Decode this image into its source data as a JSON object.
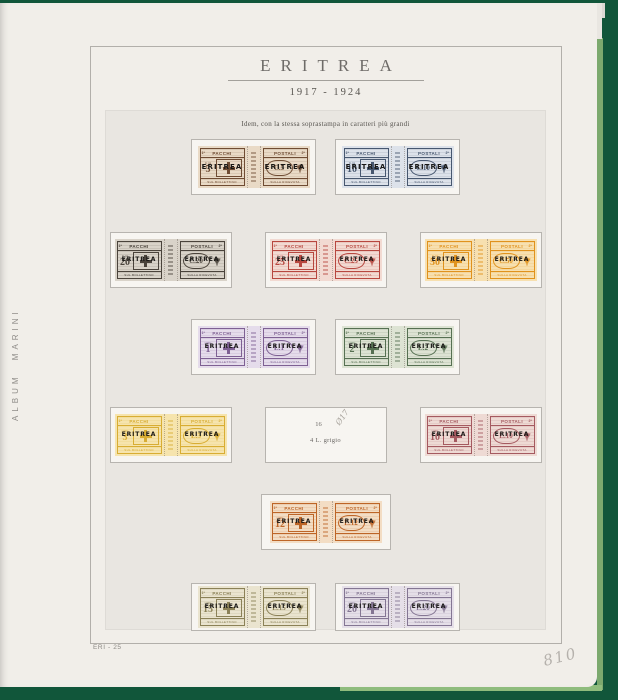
{
  "meta": {
    "album_brand": "ALBUM MARINI",
    "page_code": "ERI - 25",
    "handwritten_number": "810"
  },
  "header": {
    "title": "ERITREA",
    "years": "1917 - 1924"
  },
  "intro_note": "Idem, con la stessa soprastampa in caratteri più grandi",
  "stamp_labels": {
    "left_part_small": "1ª",
    "left_part_word": "PACCHI",
    "right_part_word": "POSTALI",
    "right_part_small": "2ª",
    "left_bottom": "SUL BOLLETTINO",
    "right_bottom": "SULLA RICEVUTA",
    "overprint": "ERITREA"
  },
  "icons": {
    "shield": "savoy-cross-shield-icon",
    "eagle": "heraldic-eagle-icon",
    "gutter": "column-ornament-icon"
  },
  "colors": {
    "cover_green": "#11563a",
    "cover_green_light": "#7ca96e",
    "page": "#f1eee9",
    "panel": "#e9e6e1",
    "mount_white": "#f7f5f1",
    "overprint_black": "#181715"
  },
  "rows": [
    {
      "items": [
        {
          "kind": "stamp",
          "value_left": "5",
          "unit": "C.mi",
          "value_right": "C.5",
          "ink": "#6f4c33",
          "paper": "#e9dac6"
        },
        {
          "kind": "stamp",
          "value_left": "10",
          "unit": "C.mi",
          "value_right": "C.10",
          "ink": "#47576f",
          "paper": "#dde2ea"
        }
      ]
    },
    {
      "items": [
        {
          "kind": "stamp",
          "value_left": "20",
          "unit": "C.mi",
          "value_right": "C.20",
          "ink": "#4a433b",
          "paper": "#d9d3c9"
        },
        {
          "kind": "stamp",
          "value_left": "25",
          "unit": "C.mi",
          "value_right": "C.25",
          "ink": "#b7473f",
          "paper": "#f2dad2"
        },
        {
          "kind": "stamp",
          "value_left": "50",
          "unit": "C.mi",
          "value_right": "C.50",
          "ink": "#e0921d",
          "paper": "#f7e0b0"
        }
      ]
    },
    {
      "items": [
        {
          "kind": "stamp",
          "value_left": "1",
          "unit": "LIRE",
          "value_right": "L.1",
          "ink": "#7e6093",
          "paper": "#e5dceb"
        },
        {
          "kind": "stamp",
          "value_left": "2",
          "unit": "LIRE",
          "value_right": "L.2",
          "ink": "#567052",
          "paper": "#dde3d3"
        }
      ]
    },
    {
      "items": [
        {
          "kind": "stamp",
          "value_left": "3",
          "unit": "LIRE",
          "value_right": "L.3",
          "ink": "#d8ad33",
          "paper": "#f6e4ad"
        },
        {
          "kind": "placeholder",
          "catalog_number": "16",
          "pencil_note": "Ø17",
          "caption": "4 L. grigio"
        },
        {
          "kind": "stamp",
          "value_left": "10",
          "unit": "LIRE",
          "value_right": "L.10",
          "ink": "#a55a60",
          "paper": "#eedad4"
        }
      ]
    },
    {
      "items": [
        {
          "kind": "stamp",
          "value_left": "12",
          "unit": "LIRE",
          "value_right": "L.12",
          "ink": "#bd6527",
          "paper": "#f3ddc4"
        }
      ]
    },
    {
      "items": [
        {
          "kind": "stamp",
          "value_left": "15",
          "unit": "LIRE",
          "value_right": "L.15",
          "ink": "#8b8157",
          "paper": "#eae4cf"
        },
        {
          "kind": "stamp",
          "value_left": "20",
          "unit": "LIRE",
          "value_right": "L.20",
          "ink": "#847693",
          "paper": "#e5dfe8"
        }
      ]
    }
  ]
}
